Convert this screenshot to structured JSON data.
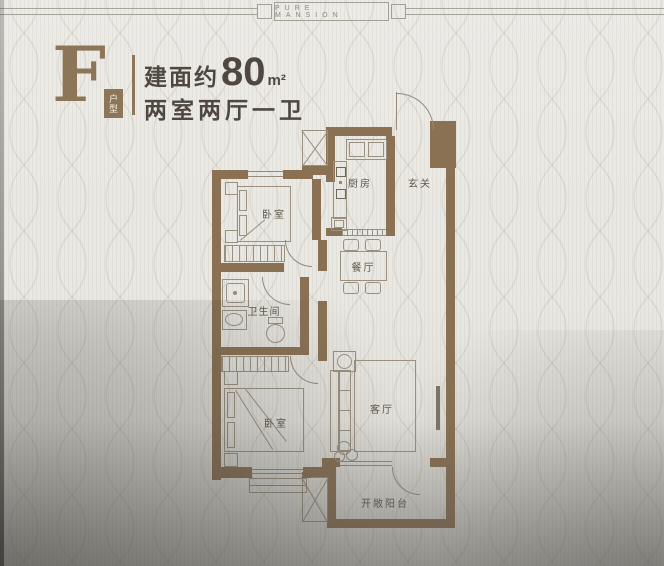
{
  "banner": {
    "brand": "PURE MANSION"
  },
  "header": {
    "plan_letter": "F",
    "plan_badge": "户型",
    "area_prefix": "建面约",
    "area_value": "80",
    "area_unit": "m²",
    "layout": "两室两厅一卫"
  },
  "floorplan": {
    "rooms": {
      "bedroom1": {
        "label": "卧室"
      },
      "kitchen": {
        "label": "厨房"
      },
      "entry": {
        "label": "玄关"
      },
      "dining": {
        "label": "餐厅"
      },
      "bathroom": {
        "label": "卫生间"
      },
      "bedroom2": {
        "label": "卧室"
      },
      "living": {
        "label": "客厅"
      },
      "balcony": {
        "label": "开敞阳台"
      }
    }
  },
  "colors": {
    "wall": "#8a7154",
    "accent": "#8d7557",
    "paper": "#e9e7e1",
    "text_dark": "#4e4840",
    "thin_line": "#9a9080"
  }
}
